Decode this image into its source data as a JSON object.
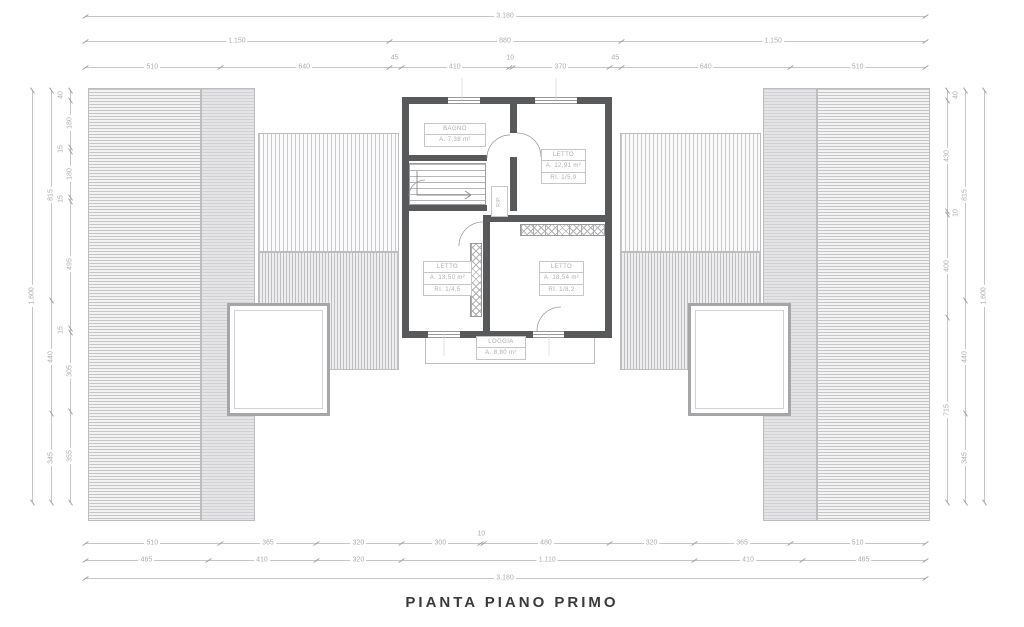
{
  "title": "PIANTA PIANO PRIMO",
  "plan": {
    "rooms": {
      "bagno": {
        "name": "BAGNO",
        "area": "A. 7,38 m²"
      },
      "letto_tr": {
        "name": "LETTO",
        "area": "A. 12,91 m²",
        "ri": "RI. 1/5,9"
      },
      "letto_bl": {
        "name": "LETTO",
        "area": "A. 13,50 m²",
        "ri": "RI. 1/4,5"
      },
      "letto_br": {
        "name": "LETTO",
        "area": "A. 18,54 m²",
        "ri": "RI. 1/8,2"
      },
      "loggia": {
        "name": "LOGGIA",
        "area": "A. 8,80 m²"
      },
      "rip": {
        "name": "RIP."
      }
    }
  },
  "colors": {
    "wall": "#58595b",
    "dimension": "#aeaeb0",
    "hatch": "#c6c6c8",
    "title": "#3a3a3c"
  },
  "dims": {
    "ox": 85,
    "span_px": 840,
    "oy": 90,
    "vspan_px": 412,
    "top_rows": [
      {
        "y": 16,
        "segments": [
          {
            "len": 3180,
            "label": "3.180"
          }
        ]
      },
      {
        "y": 41,
        "segments": [
          {
            "len": 1150,
            "label": "1.150"
          },
          {
            "len": 880,
            "label": "880"
          },
          {
            "len": 1150,
            "label": "1.150"
          }
        ]
      },
      {
        "y": 67,
        "segments": [
          {
            "len": 510,
            "label": "510"
          },
          {
            "len": 640,
            "label": "640"
          },
          {
            "len": 45,
            "label": "45"
          },
          {
            "len": 410,
            "label": "410"
          },
          {
            "len": 10,
            "label": "10"
          },
          {
            "len": 370,
            "label": "370"
          },
          {
            "len": 45,
            "label": "45"
          },
          {
            "len": 640,
            "label": "640"
          },
          {
            "len": 510,
            "label": "510"
          }
        ]
      }
    ],
    "bottom_rows": [
      {
        "y": 543,
        "segments": [
          {
            "len": 510,
            "label": "510"
          },
          {
            "len": 365,
            "label": "365"
          },
          {
            "len": 320,
            "label": "320"
          },
          {
            "len": 300,
            "label": "300"
          },
          {
            "len": 10,
            "label": "10"
          },
          {
            "len": 480,
            "label": "480"
          },
          {
            "len": 320,
            "label": "320"
          },
          {
            "len": 365,
            "label": "365"
          },
          {
            "len": 510,
            "label": "510"
          }
        ]
      },
      {
        "y": 560,
        "segments": [
          {
            "len": 465,
            "label": "465"
          },
          {
            "len": 410,
            "label": "410"
          },
          {
            "len": 320,
            "label": "320"
          },
          {
            "len": 1110,
            "label": "1.110"
          },
          {
            "len": 410,
            "label": "410"
          },
          {
            "len": 465,
            "label": "465"
          }
        ]
      },
      {
        "y": 578,
        "segments": [
          {
            "len": 3180,
            "label": "3.180"
          }
        ]
      }
    ],
    "left_cols": [
      {
        "x": 32,
        "segments": [
          {
            "len": 1600,
            "label": "1.600"
          }
        ]
      },
      {
        "x": 51,
        "segments": [
          {
            "len": 815,
            "label": "815"
          },
          {
            "len": 440,
            "label": "440"
          },
          {
            "len": 345,
            "label": "345"
          }
        ]
      },
      {
        "x": 70,
        "segments": [
          {
            "len": 40,
            "label": "40"
          },
          {
            "len": 180,
            "label": "180"
          },
          {
            "len": 15,
            "label": "15"
          },
          {
            "len": 180,
            "label": "180"
          },
          {
            "len": 15,
            "label": "15"
          },
          {
            "len": 495,
            "label": "495"
          },
          {
            "len": 15,
            "label": "15"
          },
          {
            "len": 305,
            "label": "305"
          },
          {
            "len": 355,
            "label": "355"
          }
        ]
      }
    ],
    "right_cols": [
      {
        "x": 947,
        "segments": [
          {
            "len": 40,
            "label": "40"
          },
          {
            "len": 430,
            "label": "430"
          },
          {
            "len": 10,
            "label": "10"
          },
          {
            "len": 400,
            "label": "400"
          },
          {
            "len": 715,
            "label": "715"
          }
        ]
      },
      {
        "x": 965,
        "segments": [
          {
            "len": 815,
            "label": "815"
          },
          {
            "len": 440,
            "label": "440"
          },
          {
            "len": 345,
            "label": "345"
          }
        ]
      },
      {
        "x": 984,
        "segments": [
          {
            "len": 1600,
            "label": "1.600"
          }
        ]
      }
    ]
  }
}
